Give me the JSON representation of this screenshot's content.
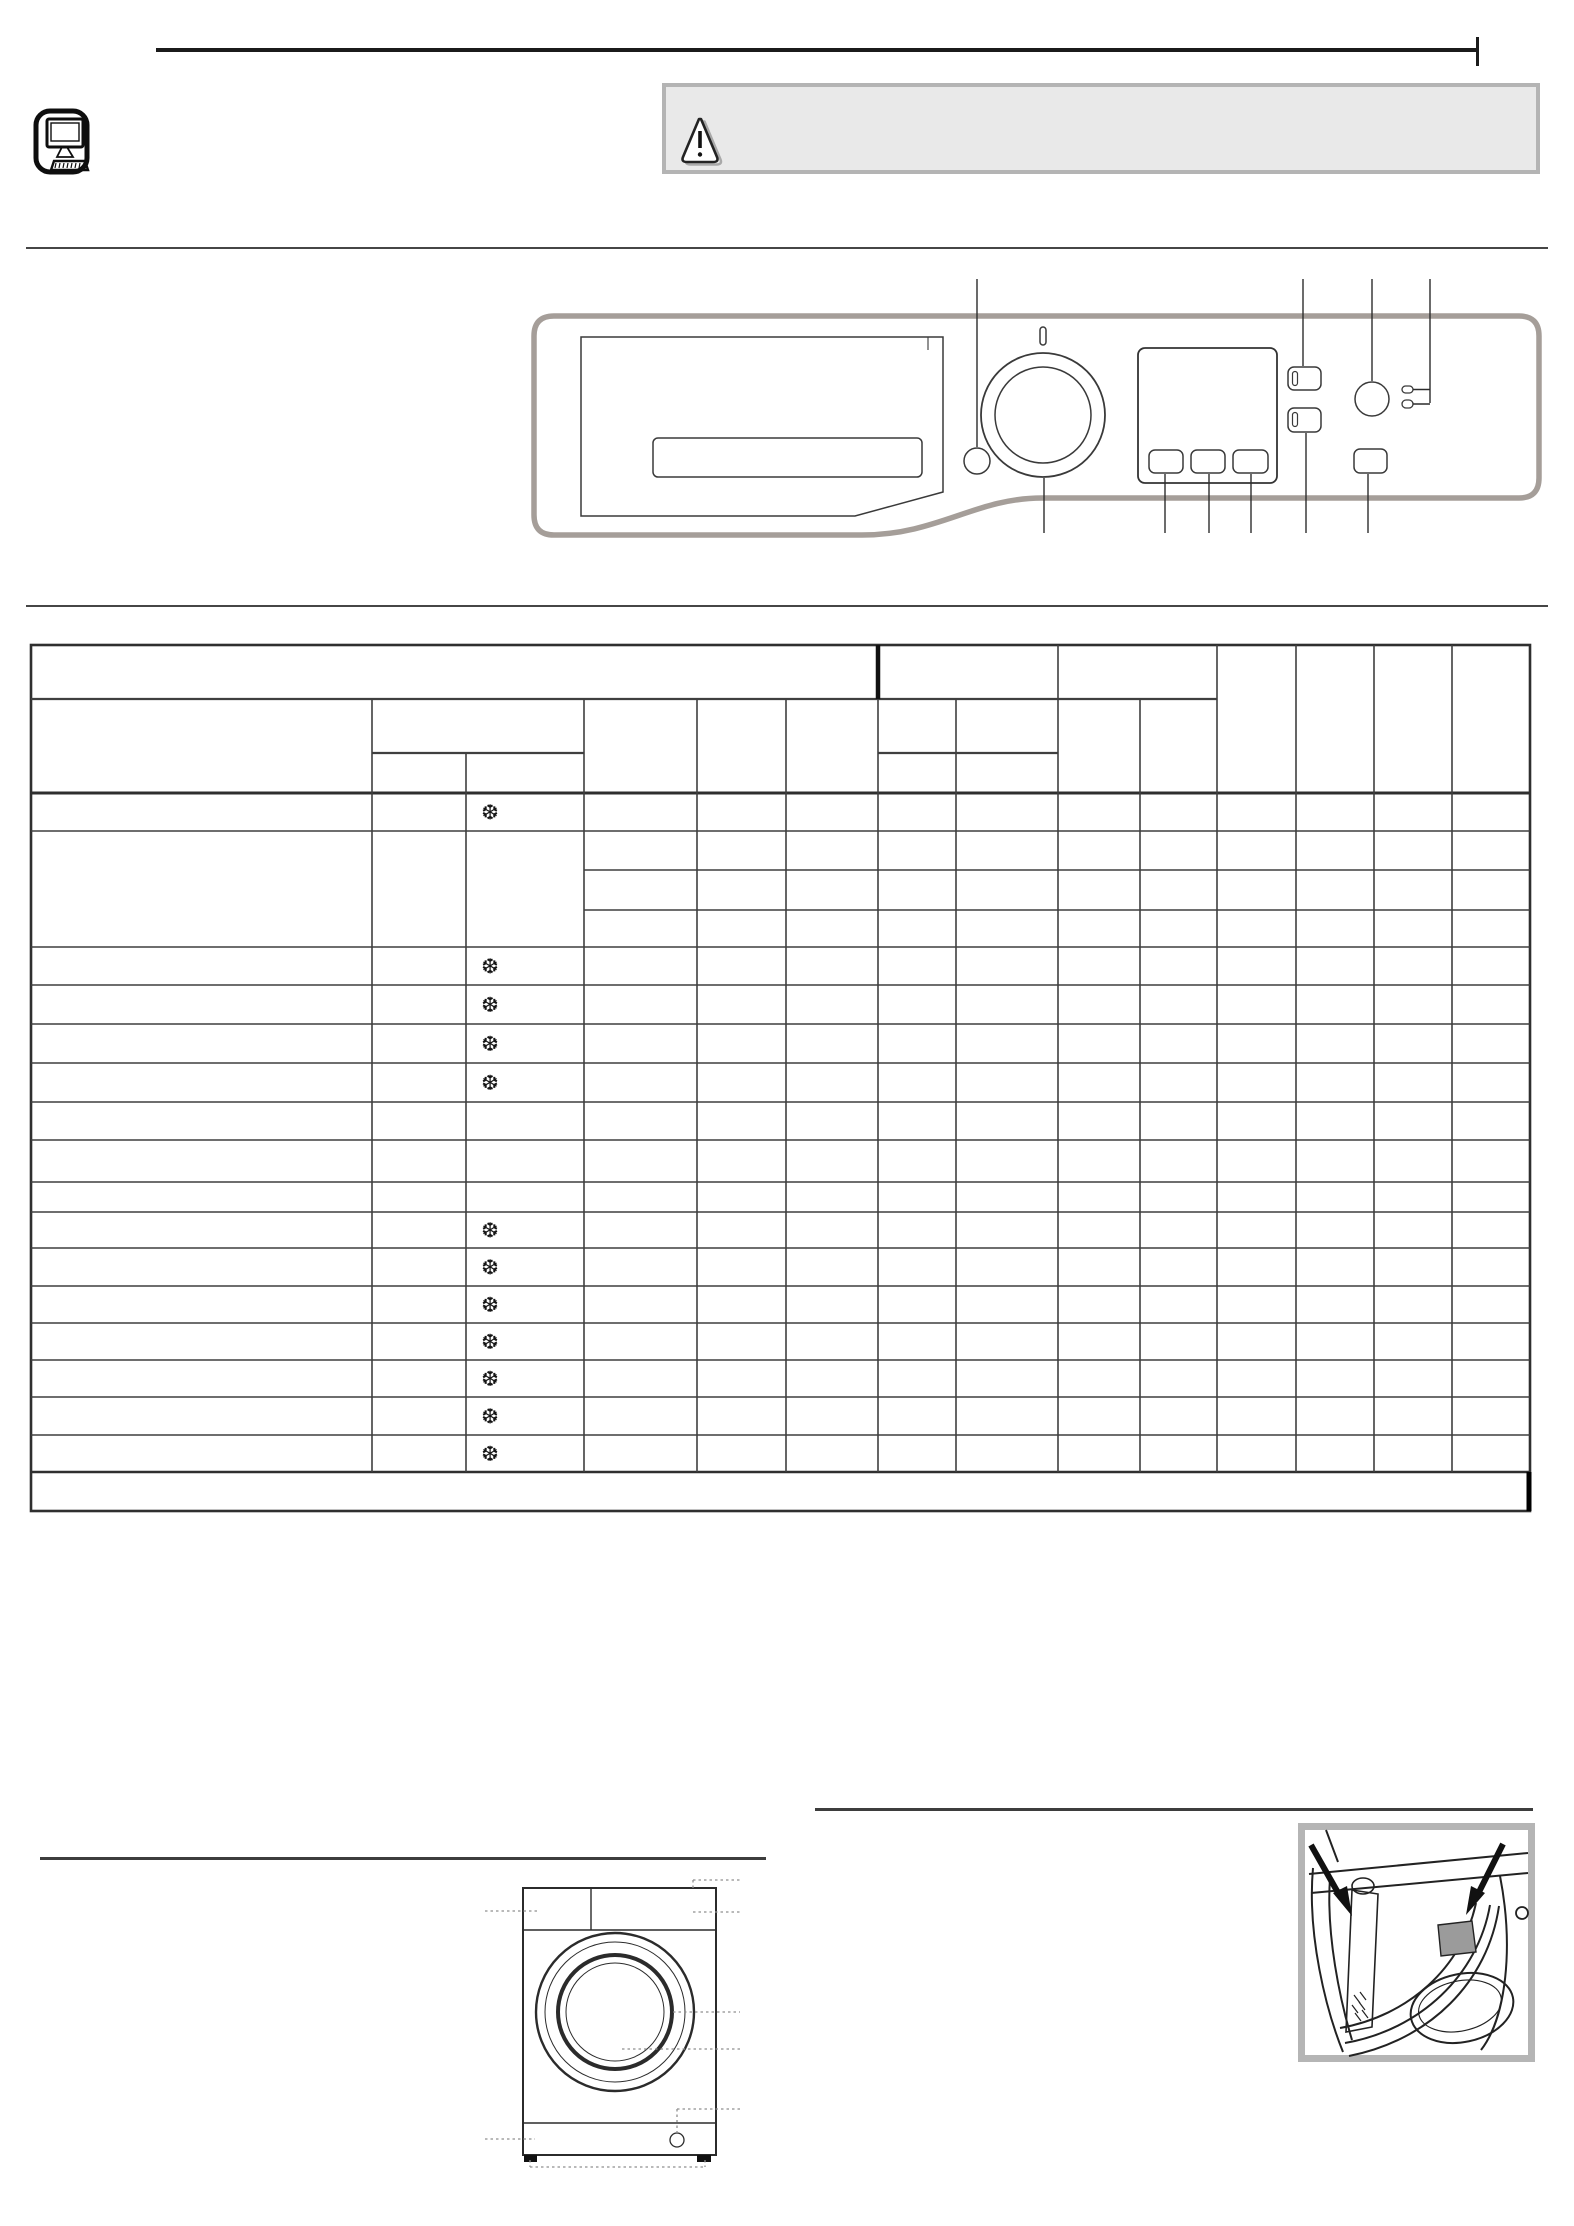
{
  "page": {
    "width": 1574,
    "height": 2226,
    "background": "#ffffff"
  },
  "header": {
    "computer_icon": "computer-icon",
    "warning": {
      "icon": "warning-triangle-icon",
      "text": "",
      "box_fill": "#e9e9e9",
      "box_border": "#b4b4b4"
    }
  },
  "control_panel": {
    "parts": [
      "detergent-drawer",
      "programme-knob",
      "knob-indicator",
      "aux-circle-button",
      "display",
      "display-button-1",
      "display-button-2",
      "display-button-3",
      "option-button-1",
      "option-button-2",
      "power-button",
      "indicator-led-1",
      "indicator-led-2",
      "start-button"
    ],
    "panel_border_color": "#a59e99",
    "line_color": "#3a3a3a",
    "callout_color": "#2c2c2c",
    "callouts_top_x": [
      977,
      1303,
      1372,
      1430
    ],
    "callouts_bottom_x": [
      1044,
      1165,
      1209,
      1251,
      1306,
      1368
    ]
  },
  "programme_table": {
    "symbol": "❆",
    "symbol_col_center_x": 490,
    "line_color": "#3f3f3f",
    "heavy_line_color": "#2f2f2f",
    "outer": {
      "x1": 31,
      "y1": 645,
      "x2": 1530,
      "y2": 1511
    },
    "verticals": [
      [
        878,
        645,
        699,
        4.5
      ],
      [
        372,
        699,
        1472,
        1.6
      ],
      [
        466,
        753,
        1472,
        1.6
      ],
      [
        584,
        699,
        1472,
        1.6
      ],
      [
        697,
        699,
        1472,
        1.6
      ],
      [
        786,
        699,
        1472,
        1.6
      ],
      [
        878,
        699,
        1472,
        1.6
      ],
      [
        956,
        699,
        1472,
        1.6
      ],
      [
        1058,
        645,
        1472,
        1.6
      ],
      [
        1140,
        699,
        1472,
        1.6
      ],
      [
        1217,
        645,
        1472,
        1.6
      ],
      [
        1296,
        645,
        1472,
        1.6
      ],
      [
        1374,
        645,
        1472,
        1.6
      ],
      [
        1452,
        645,
        1472,
        1.6
      ]
    ],
    "horizontals": [
      [
        699,
        31,
        1217,
        2.2
      ],
      [
        753,
        372,
        584,
        2.2
      ],
      [
        753,
        878,
        1058,
        2.2
      ],
      [
        793,
        31,
        1530,
        3.0
      ],
      [
        831,
        31,
        1530,
        1.6
      ],
      [
        870,
        584,
        1530,
        1.6
      ],
      [
        910,
        584,
        1530,
        1.6
      ],
      [
        947,
        31,
        1530,
        1.6
      ],
      [
        985,
        31,
        1530,
        1.6
      ],
      [
        1024,
        31,
        1530,
        1.6
      ],
      [
        1063,
        31,
        1530,
        1.6
      ],
      [
        1102,
        31,
        1530,
        1.6
      ],
      [
        1140,
        31,
        1530,
        1.6
      ],
      [
        1182,
        31,
        1530,
        1.6
      ],
      [
        1212,
        31,
        1530,
        1.6
      ],
      [
        1248,
        31,
        1530,
        1.6
      ],
      [
        1286,
        31,
        1530,
        1.6
      ],
      [
        1323,
        31,
        1530,
        1.6
      ],
      [
        1360,
        31,
        1530,
        1.6
      ],
      [
        1397,
        31,
        1530,
        1.6
      ],
      [
        1435,
        31,
        1530,
        1.6
      ],
      [
        1472,
        31,
        1530,
        2.6
      ]
    ],
    "rows": [
      {
        "y1": 793,
        "y2": 831,
        "snowflake": true
      },
      {
        "y1": 831,
        "y2": 947,
        "snowflake": false
      },
      {
        "y1": 947,
        "y2": 985,
        "snowflake": true
      },
      {
        "y1": 985,
        "y2": 1024,
        "snowflake": true
      },
      {
        "y1": 1024,
        "y2": 1063,
        "snowflake": true
      },
      {
        "y1": 1063,
        "y2": 1102,
        "snowflake": true
      },
      {
        "y1": 1102,
        "y2": 1140,
        "snowflake": false
      },
      {
        "y1": 1140,
        "y2": 1182,
        "snowflake": false
      },
      {
        "y1": 1182,
        "y2": 1212,
        "snowflake": false
      },
      {
        "y1": 1212,
        "y2": 1248,
        "snowflake": true
      },
      {
        "y1": 1248,
        "y2": 1286,
        "snowflake": true
      },
      {
        "y1": 1286,
        "y2": 1323,
        "snowflake": true
      },
      {
        "y1": 1323,
        "y2": 1360,
        "snowflake": true
      },
      {
        "y1": 1360,
        "y2": 1397,
        "snowflake": true
      },
      {
        "y1": 1397,
        "y2": 1435,
        "snowflake": true
      },
      {
        "y1": 1435,
        "y2": 1472,
        "snowflake": true
      }
    ],
    "footer_row": {
      "y1": 1472,
      "y2": 1511,
      "note_text": ""
    }
  },
  "figures": {
    "machine_front": {
      "parts": [
        "detergent-drawer-zone",
        "control-panel-zone",
        "door",
        "kick-plate",
        "filter",
        "feet"
      ]
    },
    "drawer_detail": {
      "parts": [
        "detergent-compartment-arrow-left",
        "detergent-compartment-arrow-right",
        "softener-cup"
      ]
    }
  }
}
